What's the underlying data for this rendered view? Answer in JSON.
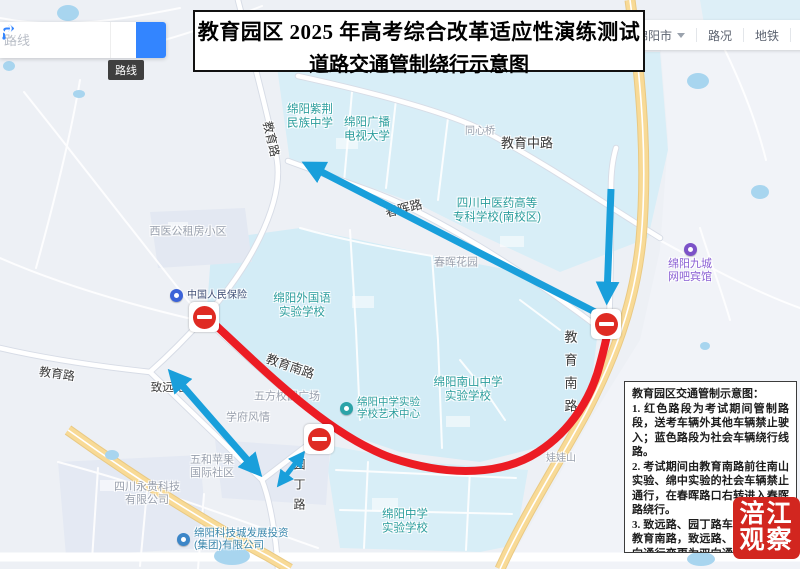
{
  "title": {
    "line1": "教育园区 2025 年高考综合改革适应性演练测试",
    "line2": "道路交通管制绕行示意图"
  },
  "search": {
    "placeholder": "路线",
    "route_tooltip": "路线"
  },
  "toolbar": {
    "city": "绵阳市",
    "traffic": "路况",
    "metro": "地铁",
    "toolbox": "工具箱"
  },
  "notice": {
    "title": "教育园区交通管制示意图：",
    "item1": "1. 红色路段为考试期间管制路段，送考车辆外其他车辆禁止驶入；蓝色路段为社会车辆绕行线路。",
    "item2": "2. 考试期间由教育南路前往南山实验、绵中实验的社会车辆禁止通行，在春晖路口右转进入春晖路绕行。",
    "item3": "3. 致远路、园丁路车辆禁止进入教育南路，致远路、园丁路由单向通行变更为双向通行，进入教育路绕行。"
  },
  "watermark": {
    "line1": "涪江",
    "line2": "观察"
  },
  "map": {
    "labels": {
      "zijing": "绵阳紫荆\n民族中学",
      "guangbo": "绵阳广播\n电视大学",
      "tongxinqiao": "同心桥",
      "rd_jiaoyu_mid": "教育中路",
      "zhongyiyao": "四川中医药高等\n专科学校(南校区)",
      "rd_chunhui": "春晖路",
      "chunhui_garden": "春晖花园",
      "xiyi": "西医公租房小区",
      "rd_jiaoyu_north": "教育路",
      "rd_jiaoyu_west": "教育路",
      "renbao": "中国人民保险",
      "waiguoyu": "绵阳外国语\n实验学校",
      "rd_jiaoyunan_diag": "教育南路",
      "wufang": "五方校园广场",
      "xuefu": "学府风情",
      "rd_zhiyuan": "致远路",
      "yishu": "绵阳中学实验\n学校艺术中心",
      "nanshan": "绵阳南山中学\n实验学校",
      "rd_jiaoyunan_vert": "教育南路",
      "wawashan": "娃娃山",
      "rd_yuanding": "园丁路",
      "wuhe": "五和苹果\n国际社区",
      "yonggui": "四川永贵科技\n有限公司",
      "kejicheng": "绵阳科技城发展投资\n(集团)有限公司",
      "mianzhong": "绵阳中学\n实验学校",
      "jiucheng": "绵阳九城\n网吧宾馆"
    }
  },
  "colors": {
    "red_route": "#ec1c24",
    "blue_arrow": "#199fdb",
    "watermark_red": "#d2261f",
    "noentry_red": "#df2b23",
    "search_blue": "#3385ff",
    "teal": "#2b9d9c",
    "gray_label": "#99a0ad"
  }
}
